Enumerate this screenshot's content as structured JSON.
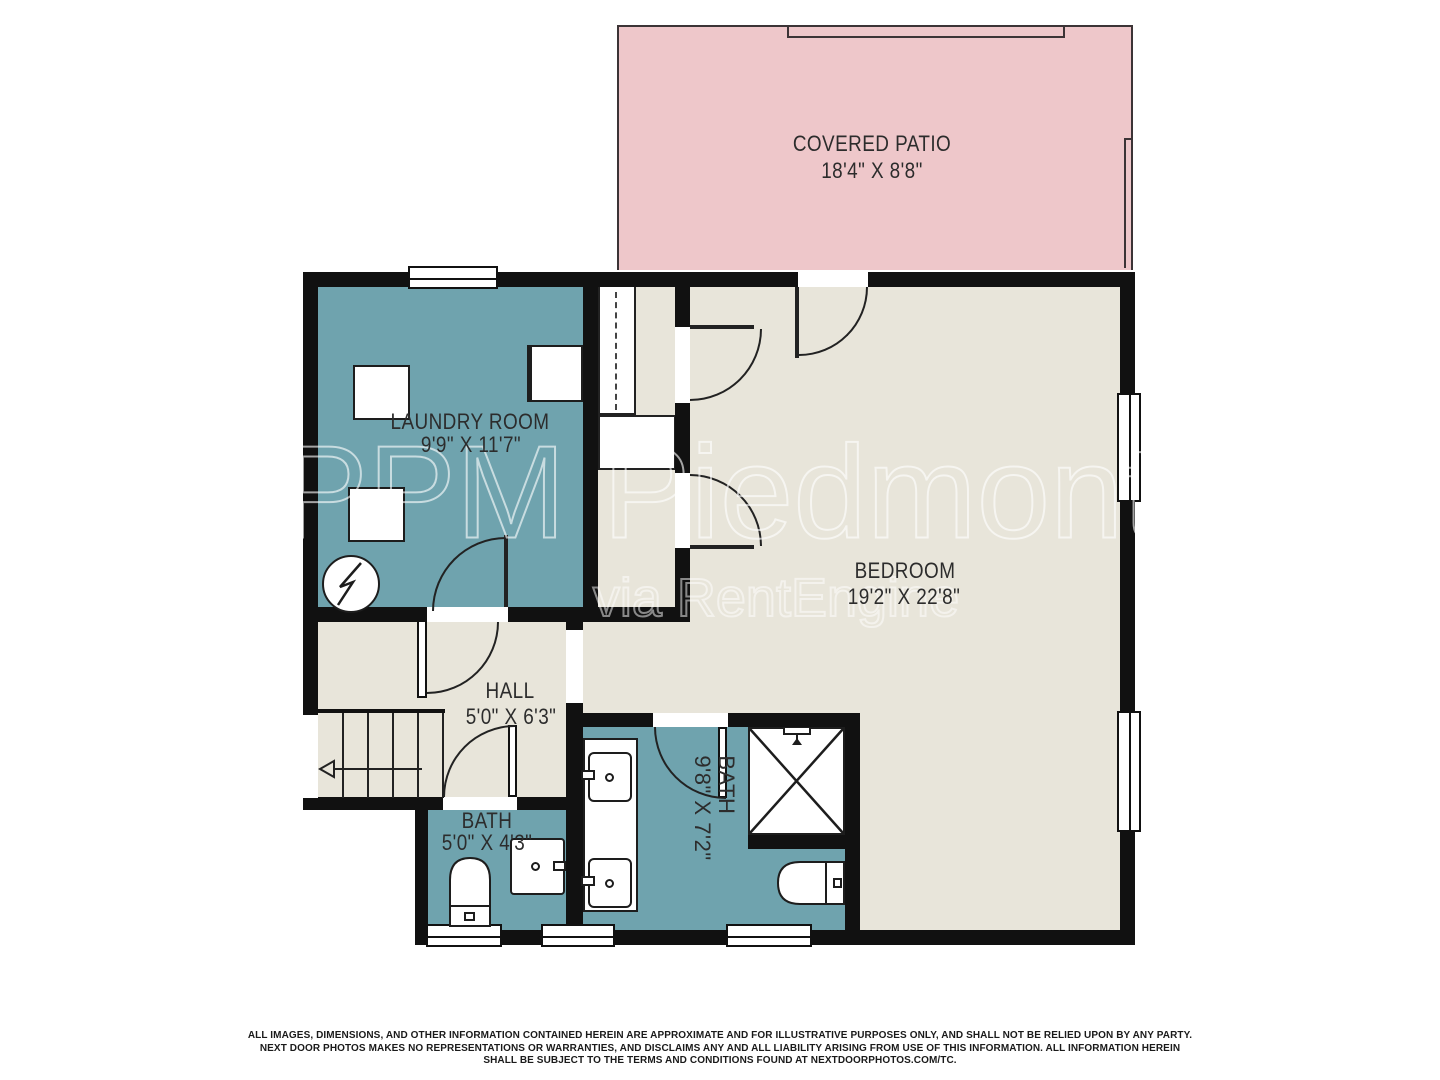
{
  "rooms": {
    "covered_patio": {
      "name": "COVERED PATIO",
      "dims": "18'4\" X 8'8\""
    },
    "laundry": {
      "name": "LAUNDRY ROOM",
      "dims": "9'9\" X 11'7\""
    },
    "bedroom": {
      "name": "BEDROOM",
      "dims": "19'2\" X 22'8\""
    },
    "hall": {
      "name": "HALL",
      "dims": "5'0\" X 6'3\""
    },
    "bath_small": {
      "name": "BATH",
      "dims": "5'0\" X 4'3\""
    },
    "bath_main": {
      "name": "BATH",
      "dims": "9'8\" X 7'2\""
    }
  },
  "watermark": {
    "primary": "PPM Piedmont",
    "secondary": "via RentEngine"
  },
  "disclaimer": {
    "line1": "ALL IMAGES, DIMENSIONS, AND OTHER INFORMATION CONTAINED HEREIN ARE APPROXIMATE AND FOR ILLUSTRATIVE PURPOSES ONLY, AND SHALL NOT BE RELIED UPON BY ANY PARTY.",
    "line2": "NEXT DOOR PHOTOS MAKES NO REPRESENTATIONS OR WARRANTIES, AND DISCLAIMS ANY AND ALL LIABILITY ARISING FROM USE OF THIS INFORMATION. ALL INFORMATION HEREIN",
    "line3": "SHALL BE SUBJECT TO THE TERMS AND CONDITIONS FOUND AT NEXTDOORPHOTOS.COM/TC."
  },
  "colors": {
    "teal": "#6fa3ae",
    "beige": "#e8e5da",
    "pink": "#eec7ca",
    "wall": "#111111"
  }
}
